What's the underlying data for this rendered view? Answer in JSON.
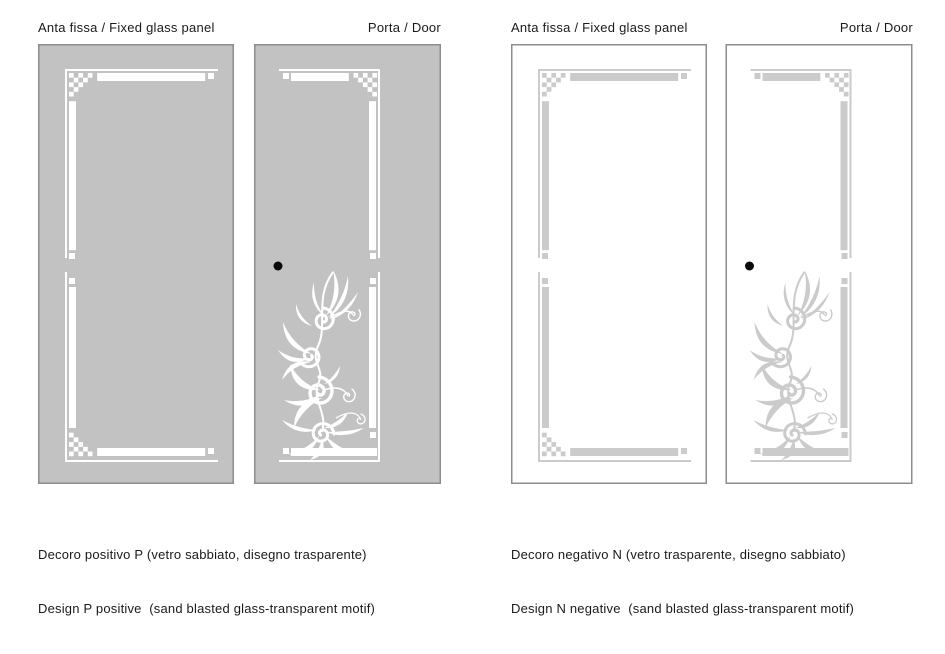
{
  "groups": {
    "positive": {
      "header": {
        "fixed_label": "Anta fissa / Fixed glass panel",
        "door_label": "Porta / Door"
      },
      "caption_line1": "Decoro positivo P (vetro sabbiato, disegno trasparente)",
      "caption_line2": "Design P positive  (sand blasted glass-transparent motif)"
    },
    "negative": {
      "header": {
        "fixed_label": "Anta fissa / Fixed glass panel",
        "door_label": "Porta / Door"
      },
      "caption_line1": "Decoro negativo N (vetro trasparente, disegno sabbiato)",
      "caption_line2": "Design N negative  (sand blasted glass-transparent motif)"
    }
  },
  "panels": [
    {
      "design": "fixed",
      "scheme": "positive",
      "has_handle": false,
      "has_floral_motif": false
    },
    {
      "design": "door",
      "scheme": "positive",
      "has_handle": true,
      "has_floral_motif": true
    },
    {
      "design": "fixed",
      "scheme": "negative",
      "has_handle": false,
      "has_floral_motif": false
    },
    {
      "design": "door",
      "scheme": "negative",
      "has_handle": true,
      "has_floral_motif": true
    }
  ],
  "colors": {
    "page_background": "#ffffff",
    "panel_glass_gray": "#c2c2c2",
    "design_white": "#ffffff",
    "design_gray": "#cbcbcb",
    "panel_outline": "#8d8d8d",
    "handle_black": "#0a0a0a",
    "text": "#1a1a1a"
  }
}
